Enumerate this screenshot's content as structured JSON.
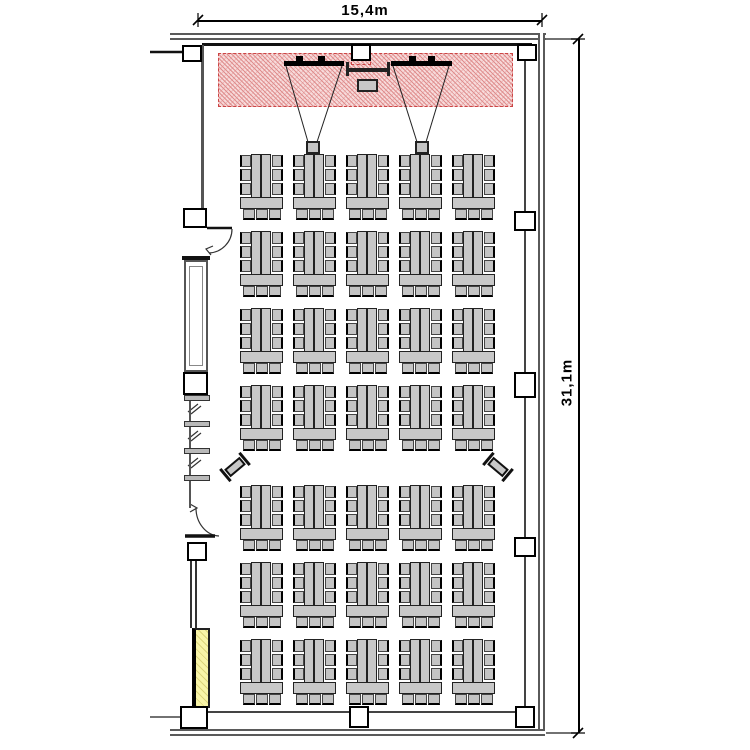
{
  "meta": {
    "type": "architectural-floor-plan",
    "description": "Conference room seating plan with stage, projection screens and classroom-style table groups"
  },
  "dimensions": {
    "width_label": "15,4m",
    "height_label": "31,1m",
    "width_m": 15.4,
    "height_m": 31.1
  },
  "stage": {
    "projection_screens": 2,
    "projectors": 2,
    "lectern": 1,
    "whiteboard": 1
  },
  "seating": {
    "rows": 7,
    "columns": 5,
    "table_groups": 35,
    "chairs_per_group": 9,
    "total_chairs": 315,
    "side_desks": 2
  },
  "features": {
    "doors": 2,
    "windows": 1,
    "pillars": 12,
    "highlight_board": 1,
    "radiator_segments": 4
  },
  "colors": {
    "stage_fill": "#f7dada",
    "stage_hatch": "#df8e8e",
    "stage_border": "#cc4444",
    "furniture_fill": "#c8c8c8",
    "furniture_outline": "#222222",
    "board_fill": "#f8f4a8",
    "wall": "#5a5a5a",
    "line": "#111111"
  },
  "layout": {
    "seating_grid": {
      "col_lefts": [
        240,
        293,
        346,
        399,
        452
      ],
      "row_tops": [
        154,
        231,
        308,
        385,
        485,
        562,
        639
      ],
      "group_w": 43,
      "group_h": 66
    },
    "pillars": [
      {
        "x": 182,
        "y": 45,
        "w": 20,
        "h": 17
      },
      {
        "x": 351,
        "y": 44,
        "w": 20,
        "h": 17
      },
      {
        "x": 517,
        "y": 44,
        "w": 20,
        "h": 17
      },
      {
        "x": 183,
        "y": 208,
        "w": 24,
        "h": 20
      },
      {
        "x": 514,
        "y": 211,
        "w": 22,
        "h": 20
      },
      {
        "x": 183,
        "y": 372,
        "w": 25,
        "h": 23
      },
      {
        "x": 514,
        "y": 372,
        "w": 22,
        "h": 26
      },
      {
        "x": 187,
        "y": 542,
        "w": 20,
        "h": 19
      },
      {
        "x": 514,
        "y": 537,
        "w": 22,
        "h": 20
      },
      {
        "x": 180,
        "y": 706,
        "w": 28,
        "h": 23
      },
      {
        "x": 349,
        "y": 706,
        "w": 20,
        "h": 22
      },
      {
        "x": 515,
        "y": 706,
        "w": 20,
        "h": 22
      }
    ],
    "radiator_bars_y": [
      395,
      421,
      448,
      475
    ],
    "side_desks": [
      {
        "x": 218,
        "y": 457,
        "angle": -40
      },
      {
        "x": 481,
        "y": 457,
        "angle": 40
      }
    ]
  }
}
